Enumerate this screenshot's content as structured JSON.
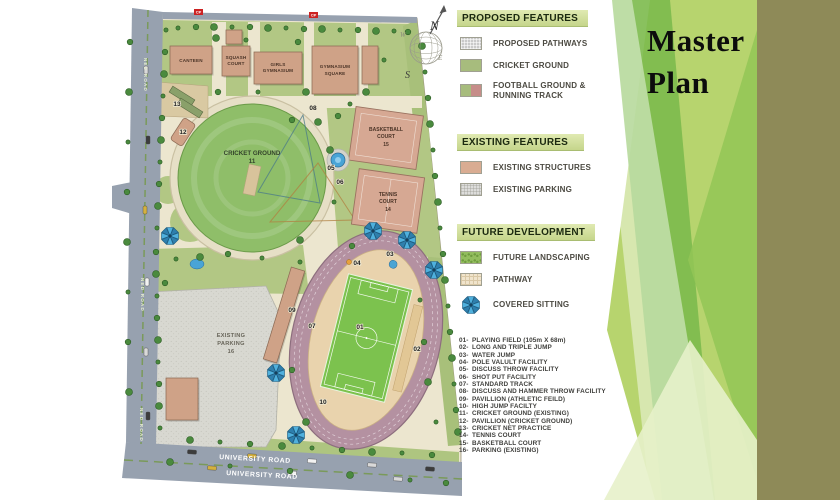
{
  "title": {
    "line1": "Master",
    "line2": "Plan"
  },
  "legend": {
    "proposed": {
      "header": "PROPOSED FEATURES",
      "items": {
        "pathways": "PROPOSED PATHWAYS",
        "cricket": "CRICKET GROUND",
        "football1": "FOOTBALL GROUND &",
        "football2": "RUNNING TRACK"
      }
    },
    "existing": {
      "header": "EXISTING FEATURES",
      "items": {
        "structures": "EXISTING STRUCTURES",
        "parking": "EXISTING PARKING"
      }
    },
    "future": {
      "header": "FUTURE DEVELOPMENT",
      "items": {
        "landscaping": "FUTURE LANDSCAPING",
        "pathway": "PATHWAY",
        "sitting": "COVERED SITTING"
      }
    }
  },
  "facilities": [
    {
      "num": "01",
      "label": "PLAYING FIELD (105m X 68m)"
    },
    {
      "num": "02",
      "label": "LONG AND TRIPLE JUMP"
    },
    {
      "num": "03",
      "label": "WATER JUMP"
    },
    {
      "num": "04",
      "label": "POLE VALULT FACILITY"
    },
    {
      "num": "05",
      "label": "DISCUSS THROW FACILITY"
    },
    {
      "num": "06",
      "label": "SHOT PUT FACILITY"
    },
    {
      "num": "07",
      "label": "STANDARD TRACK"
    },
    {
      "num": "08",
      "label": "DISCUSS AND HAMMER THROW FACILITY"
    },
    {
      "num": "09",
      "label": "PAVILLION (ATHLETIC FEILD)"
    },
    {
      "num": "10",
      "label": "HIGH JUMP FACILTY"
    },
    {
      "num": "11",
      "label": "CRICKET GROUND (EXISTING)"
    },
    {
      "num": "12",
      "label": "PAVILLION (CRICKET GROUND)"
    },
    {
      "num": "13",
      "label": "CRICKET NET PRACTICE"
    },
    {
      "num": "14",
      "label": "TENNIS COURT"
    },
    {
      "num": "15",
      "label": "BASKETBALL COURT"
    },
    {
      "num": "16",
      "label": "PARKING (EXISTING)"
    }
  ],
  "compass": {
    "n": "N",
    "s": "S",
    "e": "E",
    "w": "W"
  },
  "map": {
    "roads": {
      "left": "NED ROAD",
      "bottom": "UNIVERSITY ROAD",
      "cp": "CP"
    },
    "labels": {
      "canteen": "CANTEEN",
      "squash_1": "SQUASH",
      "squash_2": "COURT",
      "girls_1": "GIRLS",
      "girls_2": "GYMNASIUM",
      "gymsq_1": "GYMNASIUM",
      "gymsq_2": "SQUARE",
      "cricket": "CRICKET GROUND",
      "cricket_num": "11",
      "basketball_1": "BASKETBALL",
      "basketball_2": "COURT",
      "basketball_num": "15",
      "tennis_1": "TENNIS",
      "tennis_2": "COURT",
      "tennis_num": "14",
      "parking_1": "EXISTING",
      "parking_2": "PARKING",
      "parking_num": "16"
    },
    "markers": [
      {
        "n": "01",
        "x": 360,
        "y": 329
      },
      {
        "n": "02",
        "x": 417,
        "y": 351
      },
      {
        "n": "03",
        "x": 390,
        "y": 256
      },
      {
        "n": "04",
        "x": 357,
        "y": 265
      },
      {
        "n": "05",
        "x": 331,
        "y": 170
      },
      {
        "n": "06",
        "x": 340,
        "y": 184
      },
      {
        "n": "07",
        "x": 312,
        "y": 328
      },
      {
        "n": "08",
        "x": 313,
        "y": 110
      },
      {
        "n": "09",
        "x": 292,
        "y": 312
      },
      {
        "n": "10",
        "x": 323,
        "y": 404
      },
      {
        "n": "12",
        "x": 183,
        "y": 134
      },
      {
        "n": "13",
        "x": 177,
        "y": 106
      }
    ],
    "umbrellas": [
      [
        170,
        236
      ],
      [
        276,
        373
      ],
      [
        373,
        231
      ],
      [
        407,
        240
      ],
      [
        434,
        270
      ],
      [
        296,
        435
      ]
    ],
    "ponds": [
      [
        197,
        264
      ],
      [
        338,
        160
      ]
    ],
    "trees": [
      [
        166,
        30
      ],
      [
        165,
        52
      ],
      [
        164,
        74
      ],
      [
        163,
        96
      ],
      [
        162,
        118
      ],
      [
        161,
        140
      ],
      [
        160,
        162
      ],
      [
        159,
        184
      ],
      [
        158,
        206
      ],
      [
        157,
        228
      ],
      [
        156,
        252
      ],
      [
        156,
        274
      ],
      [
        157,
        296
      ],
      [
        157,
        318
      ],
      [
        158,
        340
      ],
      [
        158,
        362
      ],
      [
        159,
        384
      ],
      [
        159,
        406
      ],
      [
        160,
        428
      ],
      [
        130,
        42
      ],
      [
        129,
        92
      ],
      [
        128,
        142
      ],
      [
        127,
        192
      ],
      [
        127,
        242
      ],
      [
        128,
        292
      ],
      [
        128,
        342
      ],
      [
        129,
        392
      ],
      [
        178,
        28
      ],
      [
        196,
        27
      ],
      [
        214,
        27
      ],
      [
        232,
        27
      ],
      [
        250,
        27
      ],
      [
        268,
        28
      ],
      [
        286,
        28
      ],
      [
        304,
        29
      ],
      [
        322,
        29
      ],
      [
        340,
        30
      ],
      [
        358,
        30
      ],
      [
        376,
        31
      ],
      [
        394,
        31
      ],
      [
        408,
        32
      ],
      [
        422,
        46
      ],
      [
        425,
        72
      ],
      [
        428,
        98
      ],
      [
        430,
        124
      ],
      [
        433,
        150
      ],
      [
        435,
        176
      ],
      [
        438,
        202
      ],
      [
        440,
        228
      ],
      [
        443,
        254
      ],
      [
        445,
        280
      ],
      [
        448,
        306
      ],
      [
        450,
        332
      ],
      [
        452,
        358
      ],
      [
        454,
        384
      ],
      [
        456,
        410
      ],
      [
        458,
        432
      ],
      [
        350,
        104
      ],
      [
        338,
        116
      ],
      [
        330,
        150
      ],
      [
        334,
        202
      ],
      [
        352,
        246
      ],
      [
        300,
        240
      ],
      [
        262,
        258
      ],
      [
        228,
        254
      ],
      [
        200,
        257
      ],
      [
        176,
        259
      ],
      [
        165,
        283
      ],
      [
        190,
        440
      ],
      [
        220,
        442
      ],
      [
        250,
        444
      ],
      [
        282,
        446
      ],
      [
        312,
        448
      ],
      [
        342,
        450
      ],
      [
        372,
        452
      ],
      [
        402,
        453
      ],
      [
        432,
        455
      ],
      [
        170,
        462
      ],
      [
        230,
        466
      ],
      [
        290,
        471
      ],
      [
        350,
        475
      ],
      [
        410,
        480
      ],
      [
        446,
        483
      ],
      [
        216,
        38
      ],
      [
        246,
        40
      ],
      [
        298,
        42
      ],
      [
        306,
        92
      ],
      [
        258,
        92
      ],
      [
        218,
        92
      ],
      [
        366,
        92
      ],
      [
        384,
        60
      ],
      [
        292,
        120
      ],
      [
        318,
        122
      ],
      [
        300,
        262
      ],
      [
        292,
        370
      ],
      [
        306,
        422
      ],
      [
        420,
        300
      ],
      [
        424,
        342
      ],
      [
        428,
        382
      ],
      [
        436,
        422
      ]
    ],
    "cars_left": [
      [
        146,
        70
      ],
      [
        148,
        140
      ],
      [
        145,
        210
      ],
      [
        147,
        282
      ],
      [
        146,
        352
      ],
      [
        148,
        416
      ]
    ],
    "cars_bottom": [
      [
        192,
        452
      ],
      [
        252,
        456
      ],
      [
        312,
        461
      ],
      [
        372,
        465
      ],
      [
        430,
        469
      ],
      [
        212,
        468
      ],
      [
        292,
        473
      ],
      [
        398,
        479
      ]
    ]
  },
  "colors": {
    "legend_header_bg": "#ccd994",
    "olive_band": "#8e8a58",
    "wedge_green": "#7cba4c",
    "wedge_lime": "#b7d46e",
    "track": "#b491a1",
    "field_green": "#7cc24e",
    "cricket_green": "#8fbe69",
    "structure_tan": "#cfa287",
    "road_gray": "#97a1af"
  }
}
